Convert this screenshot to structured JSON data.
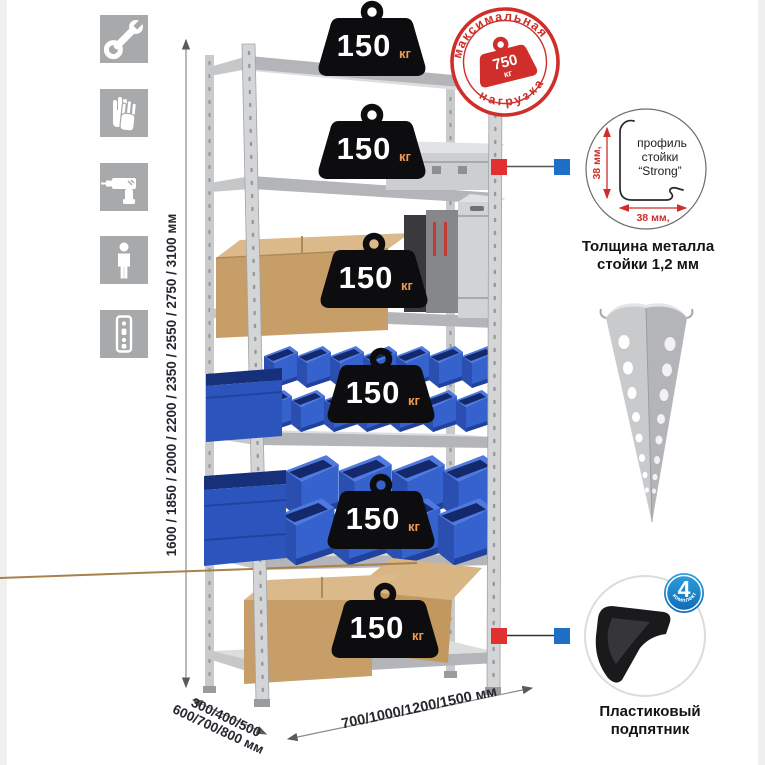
{
  "features_panel": {
    "icons": [
      {
        "name": "wrench-icon"
      },
      {
        "name": "gloves-icon"
      },
      {
        "name": "drill-icon"
      },
      {
        "name": "person-icon"
      },
      {
        "name": "upright-profile-icon"
      }
    ]
  },
  "rack": {
    "weights": [
      {
        "value": "150",
        "unit": "кг"
      },
      {
        "value": "150",
        "unit": "кг"
      },
      {
        "value": "150",
        "unit": "кг"
      },
      {
        "value": "150",
        "unit": "кг"
      },
      {
        "value": "150",
        "unit": "кг"
      },
      {
        "value": "150",
        "unit": "кг"
      }
    ]
  },
  "stamp": {
    "arc_top": "максимальная",
    "arc_bottom": "нагрузка",
    "value": "750",
    "unit": "кг"
  },
  "profile_callout": {
    "label_line1": "профиль",
    "label_line2": "стойки",
    "label_line3": "“Strong”",
    "dim_vertical": "38 мм,",
    "dim_horizontal": "38 мм,",
    "caption_line1": "Толщина металла",
    "caption_line2": "стойки 1,2 мм"
  },
  "foot_callout": {
    "badge_value": "4",
    "badge_arc_text": "в комплекте",
    "caption_line1": "Пластиковый",
    "caption_line2": "подпятник"
  },
  "dimensions": {
    "height": "1600 / 1850 / 2000 / 2200 / 2350 / 2550 / 2750 / 3100 мм",
    "depth_line1": "300/400/500",
    "depth_line2": "600/700/800 мм",
    "width": "700/1000/1200/1500 мм"
  },
  "colors": {
    "stamp_red": "#cf2e2a",
    "marker_red": "#e22f2f",
    "marker_blue": "#1e6fc5",
    "bin_blue": "#3562cc",
    "cardboard": "#c79d68",
    "metal_gray": "#d2d3d5",
    "weight_black": "#0d0d10",
    "kg_orange": "#f09b52",
    "badge_blue": "#1587cd",
    "icon_gray": "#a7a9ab"
  }
}
